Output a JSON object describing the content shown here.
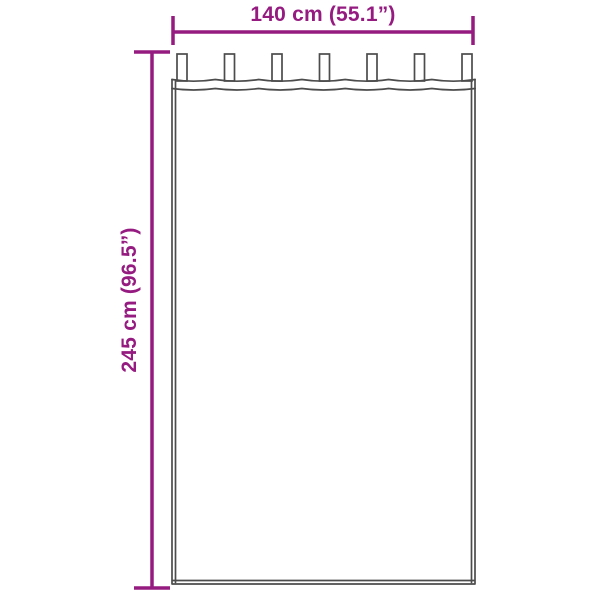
{
  "diagram": {
    "width_dimension": {
      "label": "140 cm (55.1”)",
      "value_cm": 140,
      "value_inches": 55.1
    },
    "height_dimension": {
      "label": "245 cm (96.5”)",
      "value_cm": 245,
      "value_inches": 96.5
    },
    "tab_count": 7,
    "colors": {
      "dimension": "#951b81",
      "outline": "#4c4c4c",
      "background": "#ffffff"
    }
  }
}
